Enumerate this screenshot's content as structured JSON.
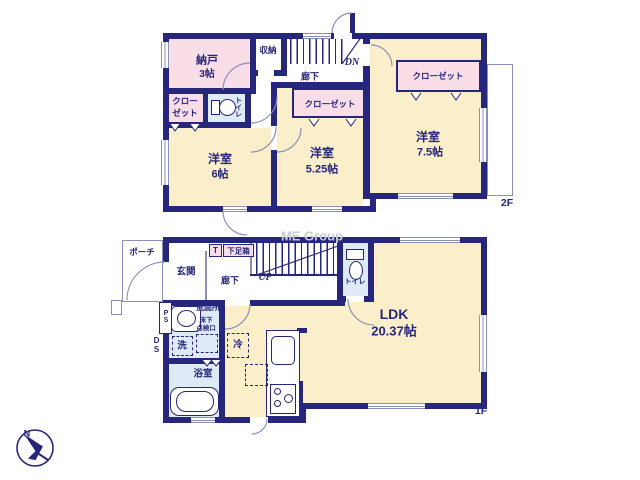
{
  "watermark": "ME Group",
  "compass": {
    "north": "N"
  },
  "floor2": {
    "floor_label": "2F",
    "nando": "納戸",
    "nando_size": "3帖",
    "shuno": "収納",
    "roka": "廊下",
    "dn": "DN",
    "closet_left_1": "クロー",
    "closet_left_2": "ゼット",
    "toilet": "トイレ",
    "closet_mid": "クローゼット",
    "closet_right": "クローゼット",
    "room6": "洋室",
    "room6_size": "6帖",
    "room525": "洋室",
    "room525_size": "5.25帖",
    "room75": "洋室",
    "room75_size": "7.5帖"
  },
  "floor1": {
    "floor_label": "1F",
    "porch": "ポーチ",
    "genkan": "玄関",
    "shoe_t": "T",
    "shoe_box": "下足箱",
    "roka": "廊下",
    "up": "UP",
    "toilet": "トイレ",
    "ldk": "LDK",
    "ldk_size": "20.37帖",
    "ps": "PS",
    "ds": "DS",
    "senmenjo": "洗面所",
    "yukashita_1": "床下",
    "yukashita_2": "点検口",
    "washer": "洗",
    "fridge": "冷",
    "bath": "浴室"
  }
}
